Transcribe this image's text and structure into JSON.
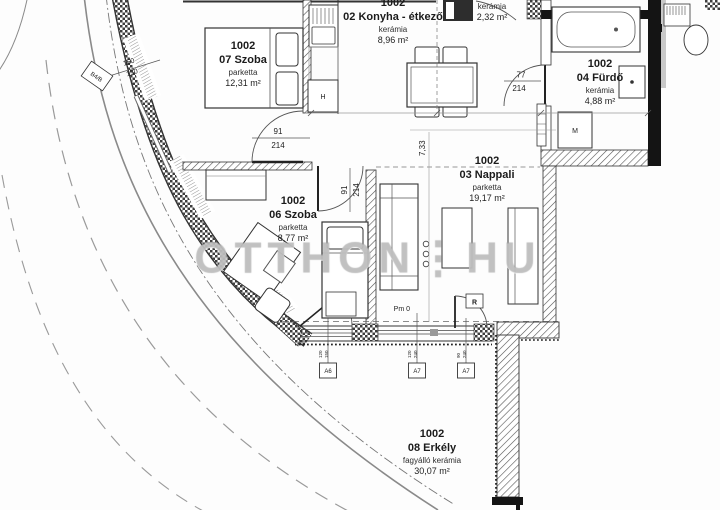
{
  "watermark": "OTTHON⋮HU",
  "rooms": {
    "room07": {
      "unit": "1002",
      "name": "07 Szoba",
      "finish": "parketta",
      "area": "12,31 m²"
    },
    "kitchen": {
      "unit": "1002",
      "name": "02 Konyha - étkező",
      "finish": "kerámia",
      "area": "8,96 m²"
    },
    "hall": {
      "finish": "kerámia",
      "area": "2,32 m²"
    },
    "bath": {
      "unit": "1002",
      "name": "04 Fürdő",
      "finish": "kerámia",
      "area": "4,88 m²"
    },
    "living": {
      "unit": "1002",
      "name": "03 Nappali",
      "finish": "parketta",
      "area": "19,17 m²"
    },
    "room06": {
      "unit": "1002",
      "name": "06 Szoba",
      "finish": "parketta",
      "area": "8,77 m²"
    },
    "balcony": {
      "unit": "1002",
      "name": "08 Erkély",
      "finish": "fagyálló kerámia",
      "area": "30,07 m²"
    }
  },
  "dims": {
    "door07_w": "91",
    "door07_h": "214",
    "door06_w": "91",
    "door06_h": "214",
    "bathdoor_w": "77",
    "bathdoor_h": "214",
    "living_w": "7,33",
    "win07_a": "150",
    "win07_b": "130",
    "pm": "Pm 0",
    "sill1_a": "120",
    "sill1_b": "150",
    "sill2_a": "120",
    "sill2_b": "240",
    "sill3_a": "90",
    "sill3_b": "240"
  },
  "markers": {
    "a6": "A6",
    "a7a": "A7",
    "a7b": "A7",
    "window_tag": "B4/B",
    "shutter": "R",
    "washer": "M",
    "fridge": "H"
  }
}
